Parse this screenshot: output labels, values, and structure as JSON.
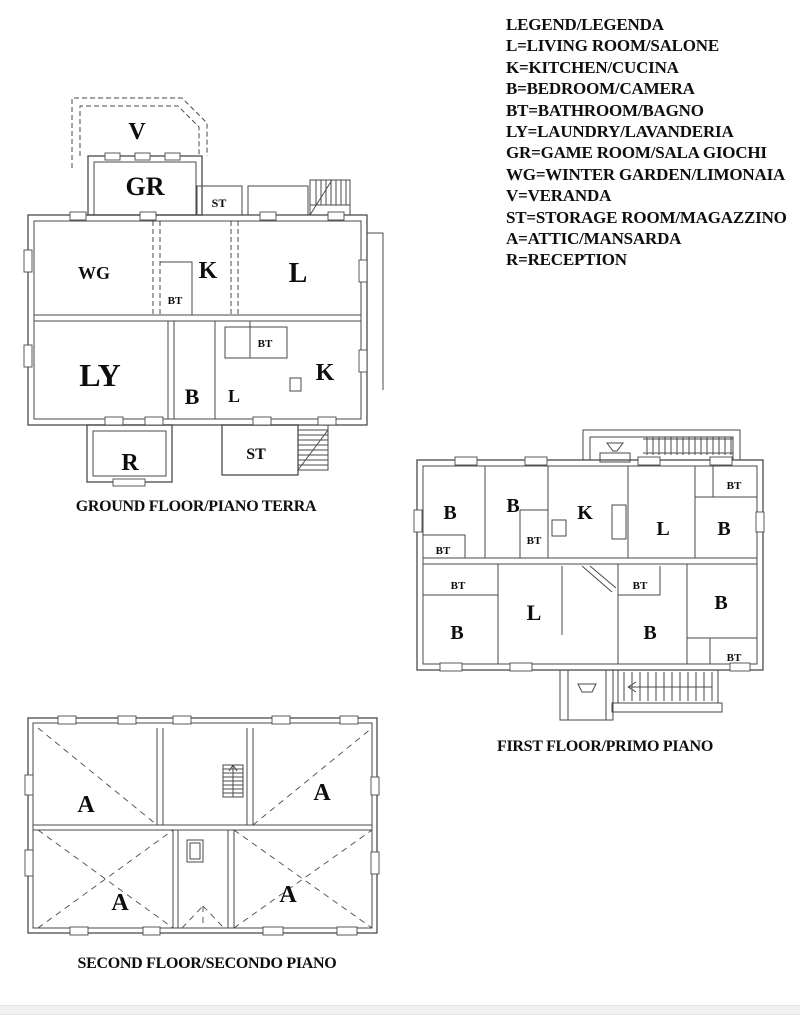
{
  "colors": {
    "background": "#ffffff",
    "wall_line": "#4a4a4a",
    "label_text": "#0d0d0d",
    "footer_bar": "#f1f1f1"
  },
  "legend": {
    "title": "LEGEND/LEGENDA",
    "entries": [
      "L=LIVING ROOM/SALONE",
      "K=KITCHEN/CUCINA",
      "B=BEDROOM/CAMERA",
      "BT=BATHROOM/BAGNO",
      "LY=LAUNDRY/LAVANDERIA",
      "GR=GAME ROOM/SALA GIOCHI",
      "WG=WINTER GARDEN/LIMONAIA",
      "V=VERANDA",
      "ST=STORAGE ROOM/MAGAZZINO",
      "A=ATTIC/MANSARDA",
      "R=RECEPTION"
    ]
  },
  "floors": {
    "ground": {
      "caption": "GROUND FLOOR/PIANO TERRA",
      "labels": {
        "v": "V",
        "gr": "GR",
        "st_top": "ST",
        "wg": "WG",
        "k_top": "K",
        "l_top": "L",
        "bt_top": "BT",
        "ly": "LY",
        "b_hall": "B",
        "l_hall": "L",
        "bt_mid": "BT",
        "k_main": "K",
        "r": "R",
        "st_bottom": "ST"
      }
    },
    "first": {
      "caption": "FIRST FLOOR/PRIMO PIANO",
      "labels": {
        "b1": "B",
        "b2": "B",
        "bt_left": "BT",
        "bt_mid": "BT",
        "k": "K",
        "l_top": "L",
        "bt_topright": "BT",
        "b3": "B",
        "bt_bottomleft": "BT",
        "b4": "B",
        "l_main": "L",
        "bt_bottommid": "BT",
        "b5": "B",
        "b6": "B",
        "bt_bottomright": "BT"
      }
    },
    "second": {
      "caption": "SECOND FLOOR/SECONDO PIANO",
      "labels": {
        "a_topleft": "A",
        "a_topright": "A",
        "a_bottomleft": "A",
        "a_bottomright": "A"
      }
    }
  }
}
